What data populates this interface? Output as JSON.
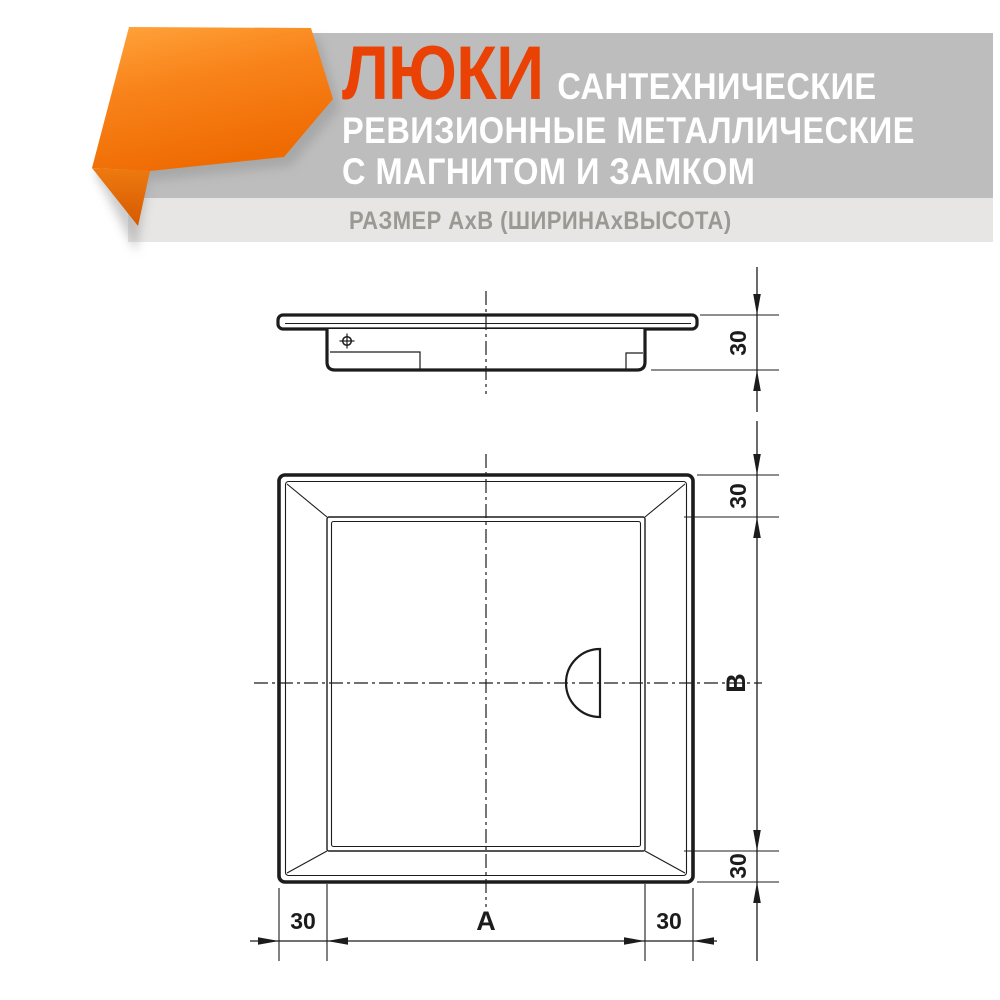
{
  "header": {
    "brand": "ЛЮКИ",
    "line1_rest": "САНТЕХНИЧЕСКИЕ",
    "line2": "РЕВИЗИОННЫЕ МЕТАЛЛИЧЕСКИЕ",
    "line3": "С МАГНИТОМ И ЗАМКОМ",
    "size_note": "РАЗМЕР АхВ (ШИРИНАхВЫСОТА)",
    "colors": {
      "brand_text": "#EA4205",
      "subtitle_text": "#FFFFFF",
      "band_dark": "#BDBDBD",
      "band_light": "#E7E6E4",
      "note_text": "#9C9893",
      "ribbon_light": "#FFA43B",
      "ribbon_dark": "#EF6B02",
      "ribbon_fold_dark": "#D55A00"
    }
  },
  "drawing": {
    "line_color": "#1C1C1C",
    "dims": {
      "side_depth": "30",
      "front_top_frame": "30",
      "front_height": "B",
      "front_bottom_frame": "30",
      "bottom_left_frame": "30",
      "front_width": "A",
      "bottom_right_frame": "30"
    }
  }
}
